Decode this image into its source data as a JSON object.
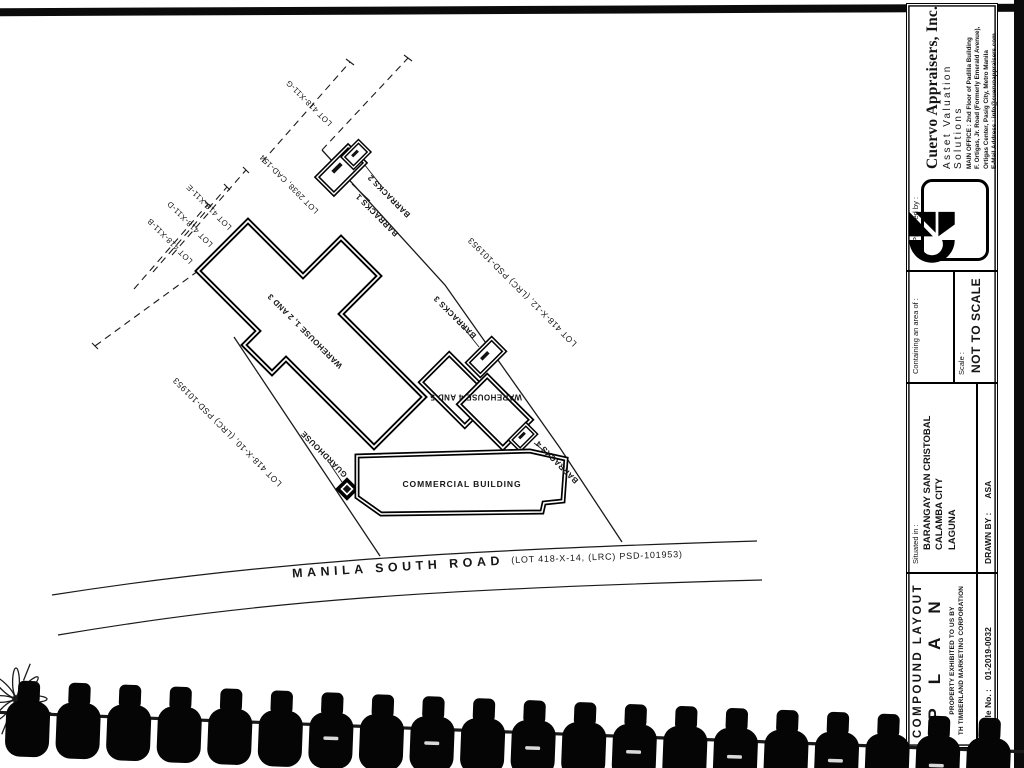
{
  "colors": {
    "ink": "#141414",
    "paper": "#ffffff"
  },
  "plan": {
    "labels": [
      {
        "id": "lot-g",
        "text": "LOT 418-X11-G"
      },
      {
        "id": "lot-2938",
        "text": "LOT 2938, CAD-154"
      },
      {
        "id": "lot-e",
        "text": "LOT 418-X11-E"
      },
      {
        "id": "lot-d",
        "text": "LOT 418-X11-D"
      },
      {
        "id": "lot-b",
        "text": "LOT 418-X11-B"
      },
      {
        "id": "barracks-2",
        "text": "BARRACKS 2"
      },
      {
        "id": "barracks-1",
        "text": "BARRACKS 1"
      },
      {
        "id": "barracks-3",
        "text": "BARRACKS 3"
      },
      {
        "id": "barracks-4",
        "text": "BARRACKS 4"
      },
      {
        "id": "lot-x12",
        "text": "LOT 418-X-12, (LRC) PSD-101953"
      },
      {
        "id": "lot-x10",
        "text": "LOT 418-X-10, (LRC) PSD-101953"
      },
      {
        "id": "warehouse-123",
        "text": "WAREHOUSE 1, 2 AND 3"
      },
      {
        "id": "warehouse-45",
        "text": "WAREHOUSE 4 AND 5"
      },
      {
        "id": "guardhouse",
        "text": "GUARDHOUSE"
      },
      {
        "id": "commercial",
        "text": "COMMERCIAL BUILDING"
      },
      {
        "id": "road-name",
        "text": "MANILA SOUTH ROAD"
      },
      {
        "id": "road-lot",
        "text": "(LOT 418-X-14, (LRC) PSD-101953)"
      }
    ]
  },
  "title_block": {
    "prepared_by_label": "Prepared by :",
    "company": {
      "name": "Cuervo Appraisers, Inc.",
      "tagline": "Asset Valuation Solutions",
      "address_line1": "MAIN OFFICE : 2nd Floor of Padilla Building",
      "address_line2": "F. Ortigas, Jr. Road (Formerly Emerald Avenue),",
      "address_line3": "Ortigas Center, Pasig City, Metro Manila",
      "address_line4": "E-Mail Address : info@cuervoappraisers.com"
    },
    "containing_label": "Containing an area of :",
    "scale_label": "Scale :",
    "scale_value": "NOT TO SCALE",
    "situated_label": "Situated in :",
    "situated_line1": "BARANGAY SAN CRISTOBAL",
    "situated_line2": "CALAMBA CITY",
    "situated_line3": "LAGUNA",
    "drawn_by_label": "DRAWN BY :",
    "drawn_by_value": "ASA",
    "title_line1": "COMPOUND LAYOUT",
    "title_line2": "PLAN",
    "property_line1": "PROPERTY EXHIBITED TO US BY",
    "property_line2": "TH TIMBERLAND MARKETING CORPORATION",
    "file_no_label": "CAI File No. :",
    "file_no_value": "01-2019-0032"
  }
}
